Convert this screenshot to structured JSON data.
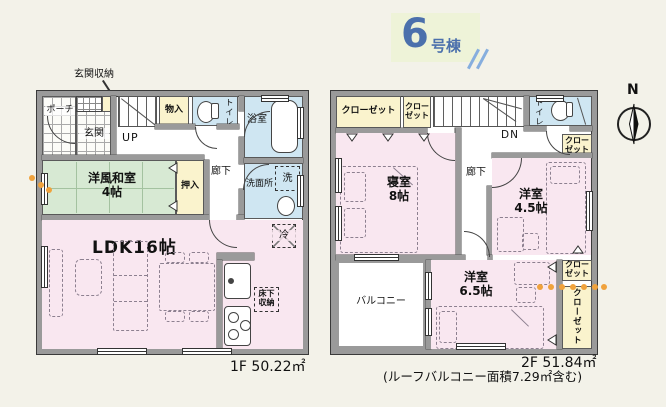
{
  "badge": {
    "number": "6",
    "suffix": "号棟",
    "text_color": "#4b70ac",
    "bg_color": "#eef3d8"
  },
  "compass": {
    "north": "N"
  },
  "floor1": {
    "area": "1F 50.22㎡",
    "labels": {
      "entrance_storage": "玄関収納",
      "porch": "ポーチ",
      "entrance": "玄関",
      "up": "UP",
      "storage": "物入",
      "toilet": "トイレ",
      "bath": "浴室",
      "hallway": "廊下",
      "washroom": "洗面所",
      "washer": "洗",
      "tatami_room": "洋風和室",
      "tatami_size": "4帖",
      "oshiire": "押入",
      "ldk": "LDK16帖",
      "underfloor_1": "床下",
      "underfloor_2": "収納",
      "fridge": "冷"
    }
  },
  "floor2": {
    "area": "2F 51.84㎡",
    "note": "(ルーフバルコニー面積7.29㎡含む)",
    "labels": {
      "closet": "クローゼット",
      "closet_line1": "クロー",
      "closet_line2": "ゼット",
      "down": "DN",
      "toilet": "トイレ",
      "bedroom": "寝室",
      "bedroom_size": "8帖",
      "hallway": "廊下",
      "western_room_a": "洋室",
      "western_room_a_size": "4.5帖",
      "western_room_b": "洋室",
      "western_room_b_size": "6.5帖",
      "closet_vertical": "クローゼット",
      "balcony": "バルコニー"
    }
  },
  "colors": {
    "wall": "#9a9a9a",
    "room_pink": "#f9e7f0",
    "tatami_green": "#d7e9d3",
    "wet_area_blue": "#cfe6f2",
    "closet_yellow": "#faf3cd",
    "accent_orange": "#f0a23c",
    "background": "#f3f2e9"
  }
}
